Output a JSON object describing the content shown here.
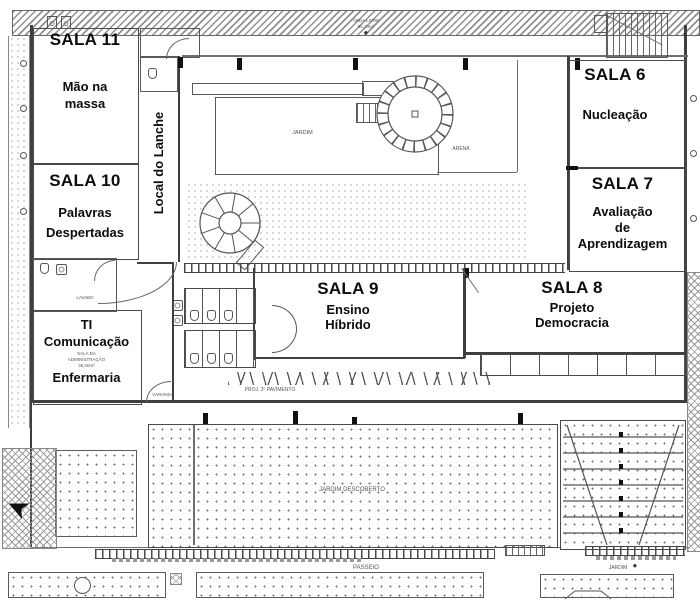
{
  "colors": {
    "line": "#3f3f3f",
    "text": "#0c0c0c",
    "background": "#ffffff",
    "texture_gray": "#8a8a8a"
  },
  "rooms": [
    {
      "id": "sala-11",
      "title": "SALA 11",
      "lines": [
        "Mão na",
        "massa"
      ]
    },
    {
      "id": "sala-10",
      "title": "SALA 10",
      "lines": [
        "Palavras",
        "Despertadas"
      ]
    },
    {
      "id": "ti-comunicacao-enfermaria",
      "lines": [
        "TI",
        "Comunicação",
        "Enfermaria"
      ]
    },
    {
      "id": "sala-9",
      "title": "SALA 9",
      "lines": [
        "Ensino",
        "Híbrido"
      ]
    },
    {
      "id": "sala-8",
      "title": "SALA 8",
      "lines": [
        "Projeto",
        "Democracia"
      ]
    },
    {
      "id": "sala-6",
      "title": "SALA 6",
      "lines": [
        "Nucleação"
      ]
    },
    {
      "id": "sala-7",
      "title": "SALA 7",
      "lines": [
        "Avaliação",
        "de",
        "Aprendizagem"
      ]
    }
  ],
  "corridor_label": "Local do Lanche",
  "annotations": {
    "jardim": "JARDIM",
    "arena": "ARENA",
    "area_livre_line1": "ÁREA LIVRE",
    "area_livre_line2": "95,20m²",
    "jardim_descoberto": "JARDIM DESCOBERTO",
    "passeio": "PASSEIO",
    "proj_segundo_pavimento": "PROJ. 2º PAVIMENTO",
    "varanda": "VARANDA",
    "lavabo": "LAVABO",
    "administracao_line1": "SALA DA",
    "administracao_line2": "ADMINISTRAÇÃO",
    "administracao_line3": "36,00m²",
    "jardim_bottom": "JARDIM"
  }
}
